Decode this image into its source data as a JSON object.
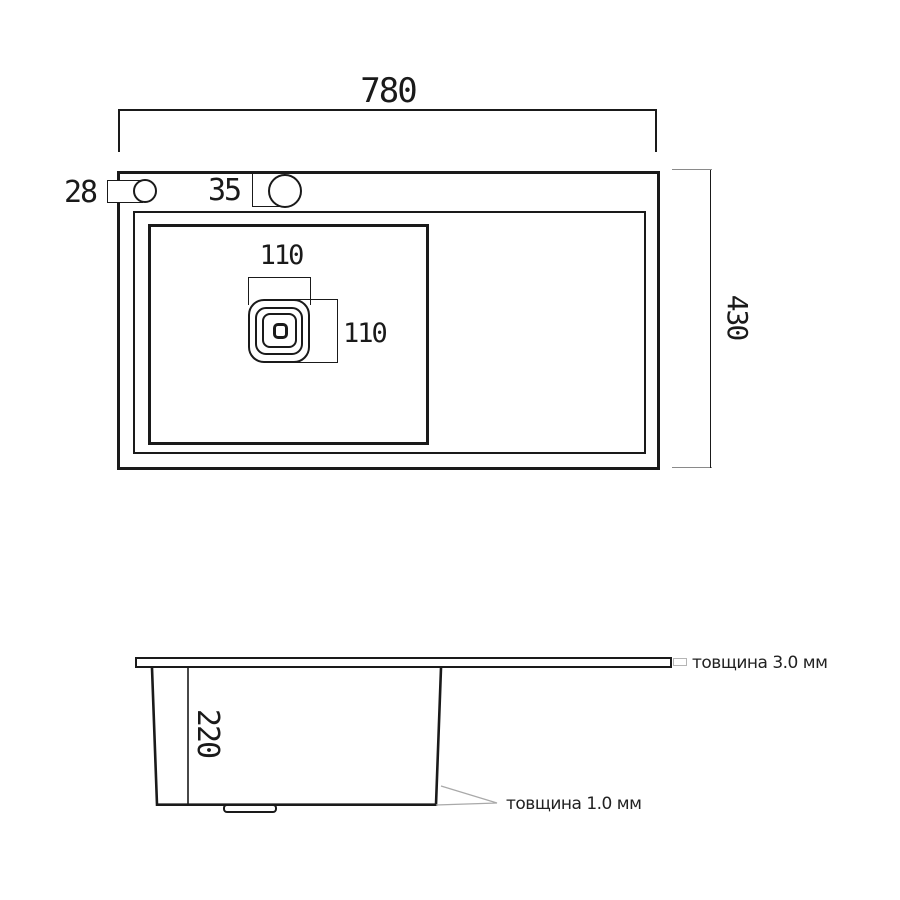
{
  "drawing": {
    "title": "kitchen sink dimension drawing",
    "top_view": {
      "width_label": "780",
      "depth_label": "430",
      "left_hole_label": "28",
      "faucet_hole_label": "35",
      "drain_width_label": "110",
      "drain_height_label": "110"
    },
    "side_view": {
      "bowl_depth_label": "220",
      "rim_thickness_label": "товщина 3.0 мм",
      "wall_thickness_label": "товщина 1.0 мм"
    },
    "colors": {
      "line": "#1a1a1a",
      "leader": "#a9a9a9",
      "thickness_box": "#b5b5b5",
      "background": "#ffffff"
    }
  }
}
